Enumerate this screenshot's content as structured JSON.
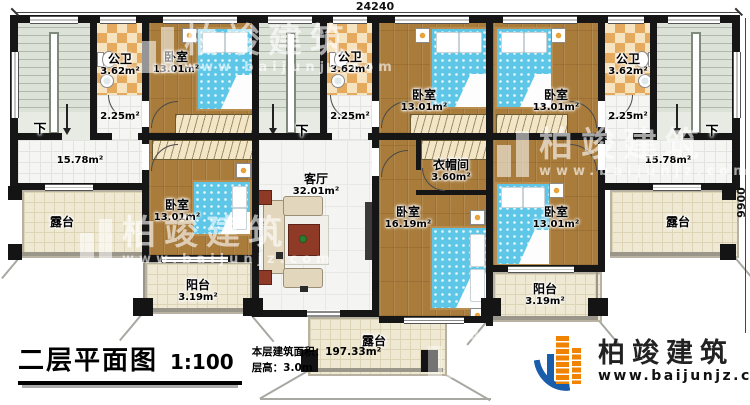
{
  "dimensions": {
    "width_top": "24240",
    "height_right": "9900"
  },
  "rooms": {
    "bath1": {
      "name": "公卫",
      "area": "3.62m²"
    },
    "bath2": {
      "name": "公卫",
      "area": "3.62m²"
    },
    "bath3": {
      "name": "公卫",
      "area": "3.62m²"
    },
    "bed1": {
      "name": "卧室",
      "area": "13.01m²"
    },
    "bed2": {
      "name": "卧室",
      "area": "13.01m²"
    },
    "bed3": {
      "name": "卧室",
      "area": "13.01m²"
    },
    "bed4": {
      "name": "卧室",
      "area": "13.01m²"
    },
    "bed5": {
      "name": "卧室",
      "area": "16.19m²"
    },
    "bed6": {
      "name": "卧室",
      "area": "13.01m²"
    },
    "living": {
      "name": "客厅",
      "area": "32.01m²"
    },
    "cloak": {
      "name": "衣帽间",
      "area": "3.60m²"
    },
    "balcony1": {
      "name": "阳台",
      "area": "3.19m²"
    },
    "balcony2": {
      "name": "阳台",
      "area": "3.19m²"
    },
    "terrace_left": {
      "name": "露台"
    },
    "terrace_right": {
      "name": "露台"
    },
    "terrace_bottom": {
      "name": "露台"
    },
    "hall1": {
      "area": "2.25m²"
    },
    "hall2": {
      "area": "2.25m²"
    },
    "hall3": {
      "area": "2.25m²"
    },
    "lobby1": {
      "area": "15.78m²"
    },
    "lobby2": {
      "area": "15.78m²"
    },
    "stairs1": {
      "down": "下"
    },
    "stairs2": {
      "down": "下"
    },
    "stairs3": {
      "down": "下"
    }
  },
  "title_block": {
    "title": "二层平面图",
    "scale": "1:100",
    "area_label": "本层建筑面积：197.33m²",
    "height_label": "层高：3.0m"
  },
  "logo": {
    "company": "柏竣建筑",
    "website": "www.baijunjz.com"
  },
  "watermark": {
    "company": "柏竣建筑",
    "website": "www.baijunjz.com"
  },
  "colors": {
    "wood_floor": "#a97c3b",
    "bed_blue": "#5ec7e8",
    "tile_tan": "#e5aa5e",
    "logo_blue": "#1a5dab",
    "logo_orange": "#f08300"
  }
}
